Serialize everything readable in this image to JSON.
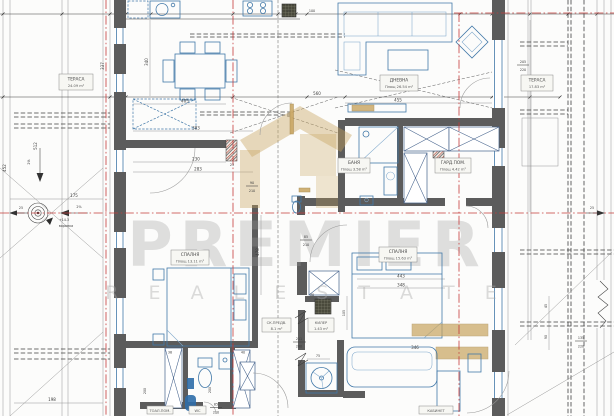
{
  "document": {
    "type": "architectural floor plan",
    "style": "CAD drawing",
    "language": "Bulgarian"
  },
  "watermark": {
    "brand": "PREMIER",
    "tagline": "R E A L   E S T A T E"
  },
  "colors": {
    "wall": "#5c5c5c",
    "furniture": "#4178a8",
    "axis_red": "#c43b3b",
    "dimension": "#3c3c3c",
    "accent_tan": "#c8a45f",
    "window_blue": "#4a86c4"
  },
  "rooms": {
    "terrace_left": {
      "name": "ТЕРАСА",
      "area": "24.09 m²"
    },
    "living": {
      "name": "ДНЕВНА",
      "area": "Площ 26.54 m²"
    },
    "terrace_right": {
      "name": "ТЕРАСА",
      "area": "17.83 m²"
    },
    "bath": {
      "name": "БАНЯ",
      "area": "Площ 3.58 m²"
    },
    "wardrobe": {
      "name": "ГАРД.ПОМ.",
      "area": "Площ 4.42 m²"
    },
    "bedroom_left": {
      "name": "СПАЛНЯ",
      "area": "Площ 13.11 m²"
    },
    "bedroom_right": {
      "name": "СПАЛНЯ",
      "area": "Площ 15.63 m²"
    },
    "vestibule": {
      "name": "СК.ПРЕДВ.",
      "area": "8.1 m²"
    },
    "closet": {
      "name": "КИЛЕР",
      "area": "1.43 m²"
    },
    "toilet": {
      "name": "ТОАЛ.ПОМ."
    },
    "wc": {
      "name": "WC"
    },
    "office": {
      "name": "КАБИНЕТ"
    }
  },
  "annotations": {
    "drain": "воронка",
    "level": "+14.3",
    "slope_a": "2%",
    "slope_b": "2%",
    "axis_left": "25",
    "axis_right": "25"
  },
  "dimensions": {
    "k25": "25",
    "k100": "100",
    "living_total": "560",
    "living_w": "455",
    "dining_w": "405",
    "hall_w": "383",
    "hall_w2": "230",
    "hall_w3": "283",
    "bed_r_w": "443",
    "bed_r_w2": "348",
    "sofa_w": "346",
    "ter_175": "175",
    "bot_198": "198",
    "v340": "340",
    "v337": "337",
    "v452": "452",
    "v512": "512",
    "v478": "478",
    "v200a": "200",
    "v200b": "200",
    "v105": "105",
    "v90": "90",
    "v45": "45",
    "win211": "211",
    "win260": "260",
    "d85a": "85",
    "d210a": "210",
    "d90": "90",
    "d210b": "210",
    "d85b": "85",
    "d210c": "210",
    "r205": "205",
    "r220": "220",
    "r135": "135",
    "r220b": "220",
    "s75": "75",
    "s30": "30",
    "s38": "38",
    "s40": "40",
    "s23": "23"
  }
}
